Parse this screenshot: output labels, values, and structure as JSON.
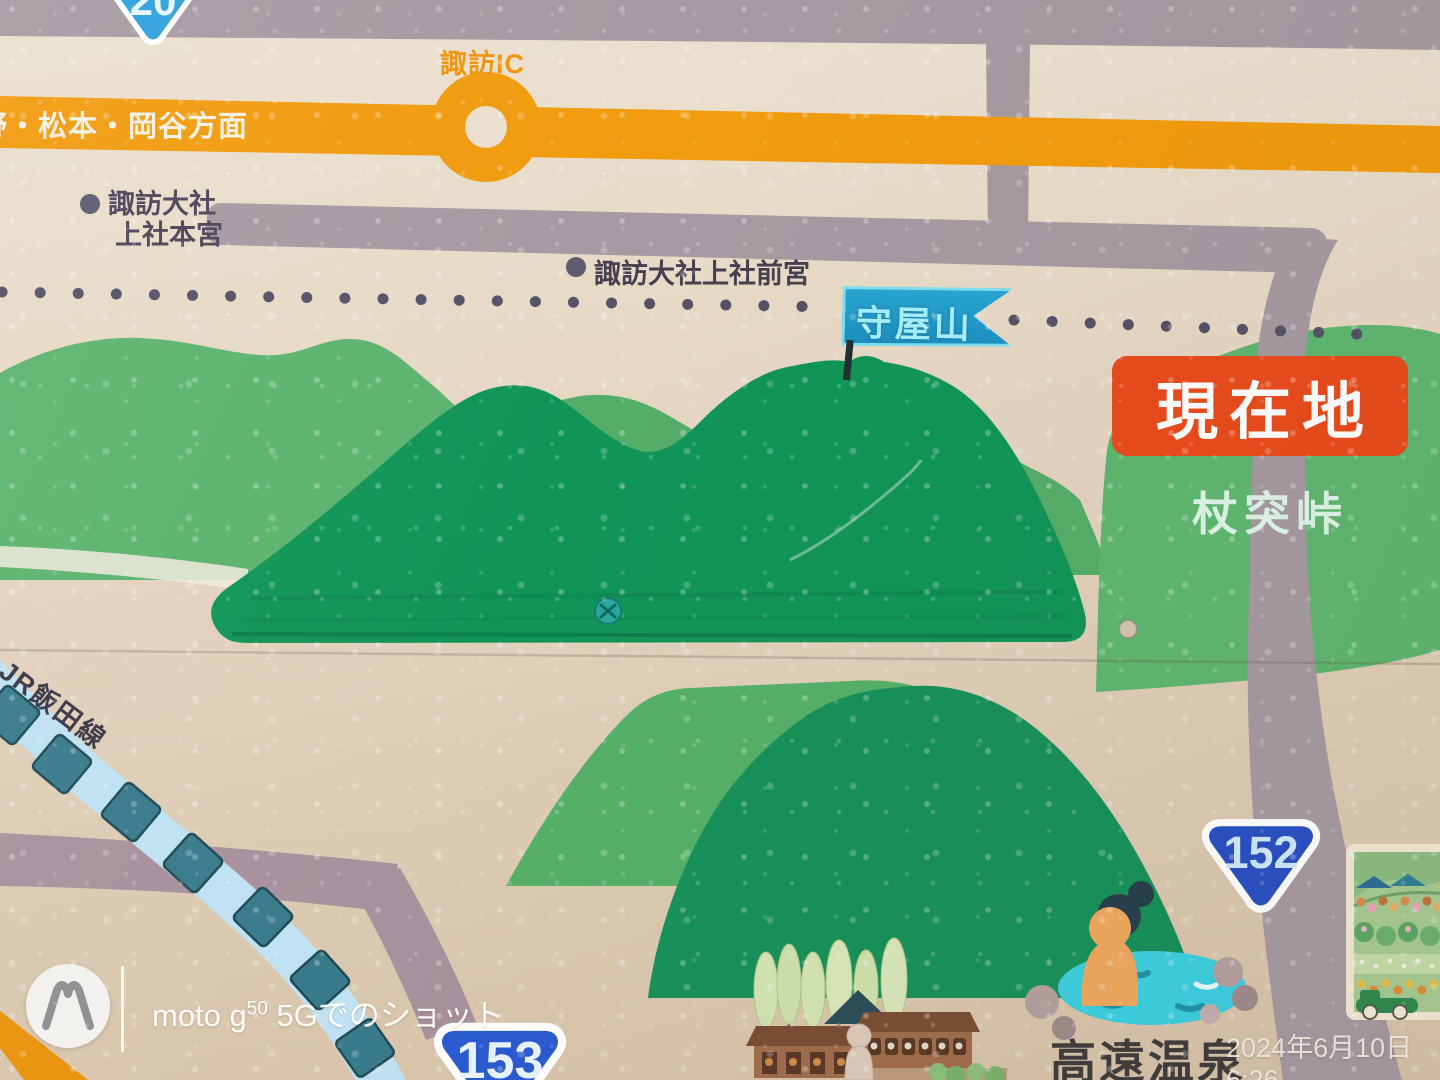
{
  "sign": {
    "shields": {
      "expressway_top": "20",
      "route_right": "152",
      "route_bottom": "153"
    },
    "labels": {
      "interchange": "諏訪IC",
      "direction": "野・松本・岡谷方面",
      "shrine_honmiya": [
        "諏訪大社",
        "上社本宮"
      ],
      "shrine_maemiya": "諏訪大社上社前宮",
      "peak_flag": "守屋山",
      "current_location": "現在地",
      "pass_name": "杖突峠",
      "railway_line": "JR飯田線",
      "hot_spring": "高遠温泉"
    },
    "colors": {
      "expressway_orange": "#f19b0e",
      "road_gray": "#a59aa1",
      "road_mauve": "#a8919c",
      "current_location_red": "#e84b1c",
      "flag_blue": "#1f9dc9",
      "route_shield_blue": "#2a50c4",
      "mountain_green": "#119557",
      "hill_green": "#5cb36e",
      "railway_blue": "#bfe1f1",
      "onsen_water_cyan": "#3ccfe0"
    }
  },
  "watermark": {
    "brand_prefix": "moto g",
    "brand_sup": "50",
    "brand_suffix": " 5Gでのショット",
    "timestamp": "2024年6月10日 6:26"
  }
}
